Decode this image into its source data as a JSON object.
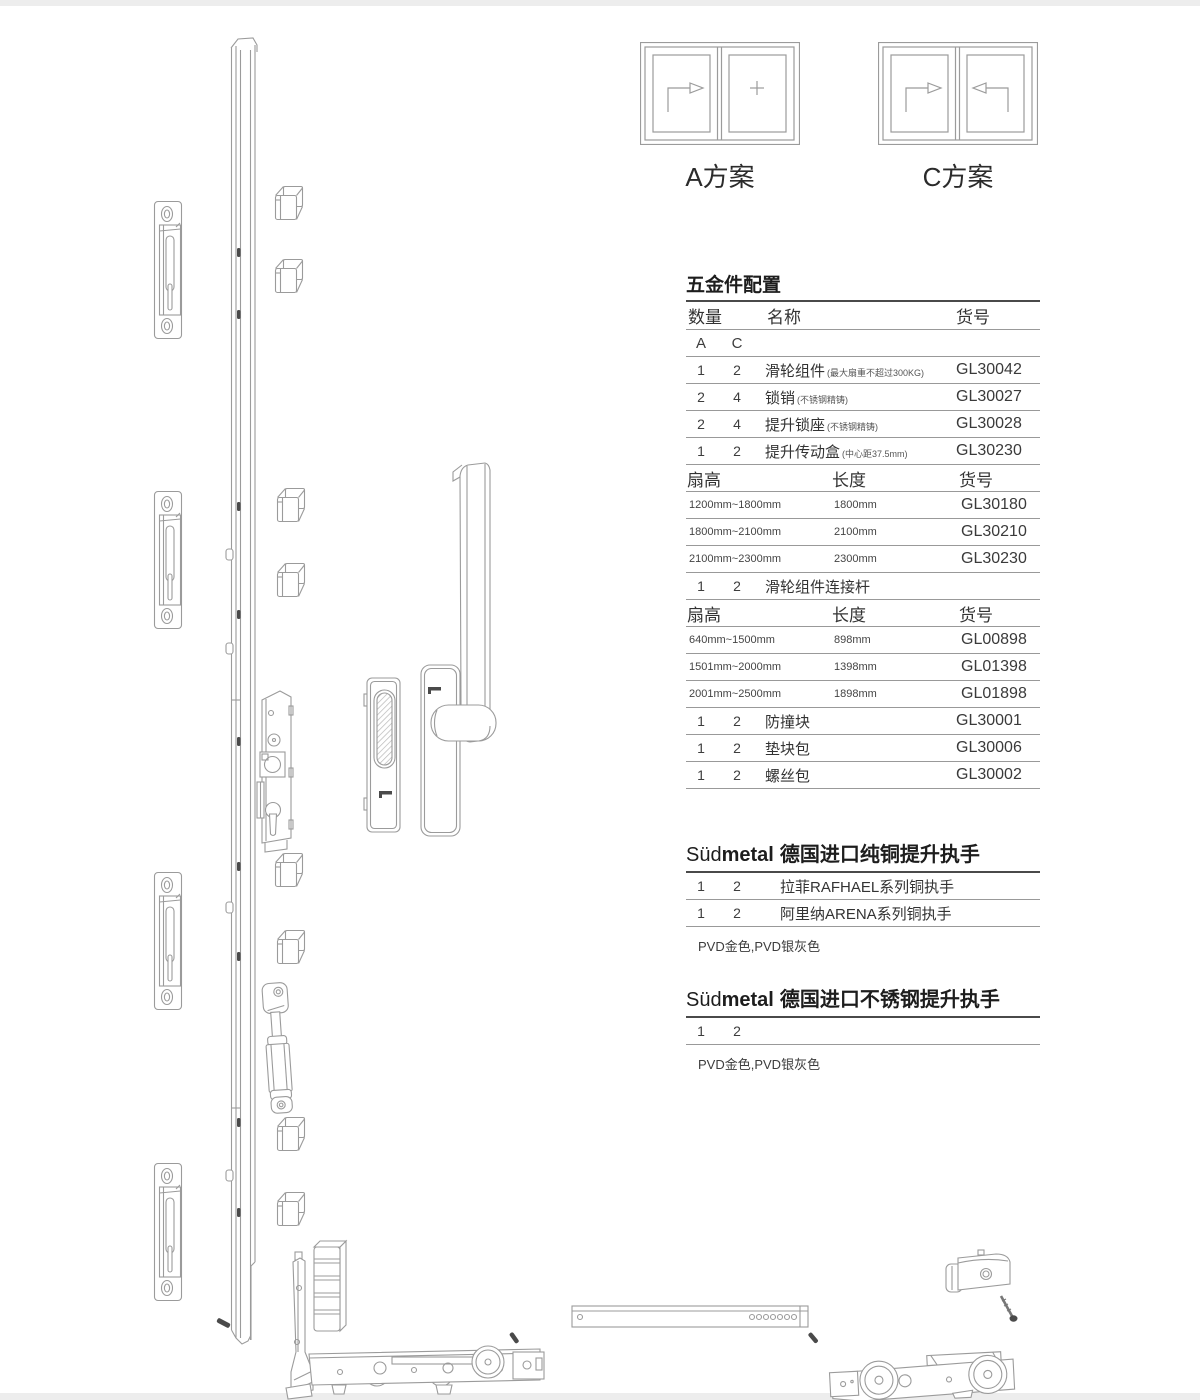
{
  "window_plans": [
    {
      "label": "A方案",
      "pane_symbols": [
        "slide-right-arrow",
        "fixed-plus"
      ]
    },
    {
      "label": "C方案",
      "pane_symbols": [
        "slide-right-arrow",
        "slide-left-arrow"
      ]
    }
  ],
  "hardware_table": {
    "title": "五金件配置",
    "headers": {
      "qty": "数量",
      "name": "名称",
      "code": "货号"
    },
    "rows": [
      {
        "kind": "ac",
        "a": "A",
        "c": "C"
      },
      {
        "kind": "part",
        "a": "1",
        "c": "2",
        "name": "滑轮组件",
        "note": "(最大扇重不超过300KG)",
        "code": "GL30042"
      },
      {
        "kind": "part",
        "a": "2",
        "c": "4",
        "name": "锁销",
        "note": "(不锈钢精铸)",
        "code": "GL30027"
      },
      {
        "kind": "part",
        "a": "2",
        "c": "4",
        "name": "提升锁座",
        "note": "(不锈钢精铸)",
        "code": "GL30028"
      },
      {
        "kind": "part",
        "a": "1",
        "c": "2",
        "name": "提升传动盒",
        "note": "(中心距37.5mm)",
        "code": "GL30230"
      },
      {
        "kind": "sizehead",
        "c1": "扇高",
        "c2": "长度",
        "c3": "货号"
      },
      {
        "kind": "size",
        "c1": "1200mm~1800mm",
        "c2": "1800mm",
        "c3": "GL30180"
      },
      {
        "kind": "size",
        "c1": "1800mm~2100mm",
        "c2": "2100mm",
        "c3": "GL30210"
      },
      {
        "kind": "size",
        "c1": "2100mm~2300mm",
        "c2": "2300mm",
        "c3": "GL30230"
      },
      {
        "kind": "part",
        "a": "1",
        "c": "2",
        "name": "滑轮组件连接杆",
        "note": "",
        "code": ""
      },
      {
        "kind": "sizehead",
        "c1": "扇高",
        "c2": "长度",
        "c3": "货号"
      },
      {
        "kind": "size",
        "c1": "640mm~1500mm",
        "c2": "898mm",
        "c3": "GL00898"
      },
      {
        "kind": "size",
        "c1": "1501mm~2000mm",
        "c2": "1398mm",
        "c3": "GL01398"
      },
      {
        "kind": "size",
        "c1": "2001mm~2500mm",
        "c2": "1898mm",
        "c3": "GL01898"
      },
      {
        "kind": "part",
        "a": "1",
        "c": "2",
        "name": "防撞块",
        "note": "",
        "code": "GL30001"
      },
      {
        "kind": "part",
        "a": "1",
        "c": "2",
        "name": "垫块包",
        "note": "",
        "code": "GL30006"
      },
      {
        "kind": "part",
        "a": "1",
        "c": "2",
        "name": "螺丝包",
        "note": "",
        "code": "GL30002"
      }
    ]
  },
  "brass_handles": {
    "brand_prefix": "Süd",
    "brand_suffix": "metal",
    "title": "德国进口纯铜提升执手",
    "rows": [
      {
        "a": "1",
        "c": "2",
        "name": "拉菲RAFHAEL系列铜执手"
      },
      {
        "a": "1",
        "c": "2",
        "name": "阿里纳ARENA系列铜执手"
      }
    ],
    "finish_note": "PVD金色,PVD银灰色"
  },
  "steel_handles": {
    "brand_prefix": "Süd",
    "brand_suffix": "metal",
    "title": "德国进口不锈钢提升执手",
    "rows": [
      {
        "a": "1",
        "c": "2"
      }
    ],
    "finish_note": "PVD金色,PVD银灰色"
  },
  "diagram_parts": [
    "lock-rail",
    "lift-lock-keeper-plate",
    "spacer-block-clip",
    "lift-gearbox",
    "lock-pin-cylinder",
    "flush-pull-handle",
    "lift-lever-handle",
    "corner-guide",
    "buffer-block",
    "roller-carriage-left",
    "connecting-bar",
    "roller-carriage-right",
    "anti-collision-block",
    "screw"
  ],
  "colors": {
    "line": "#9b9b9b",
    "rule": "#999999",
    "text": "#3d3d3d",
    "dark": "#4a4a4a"
  }
}
